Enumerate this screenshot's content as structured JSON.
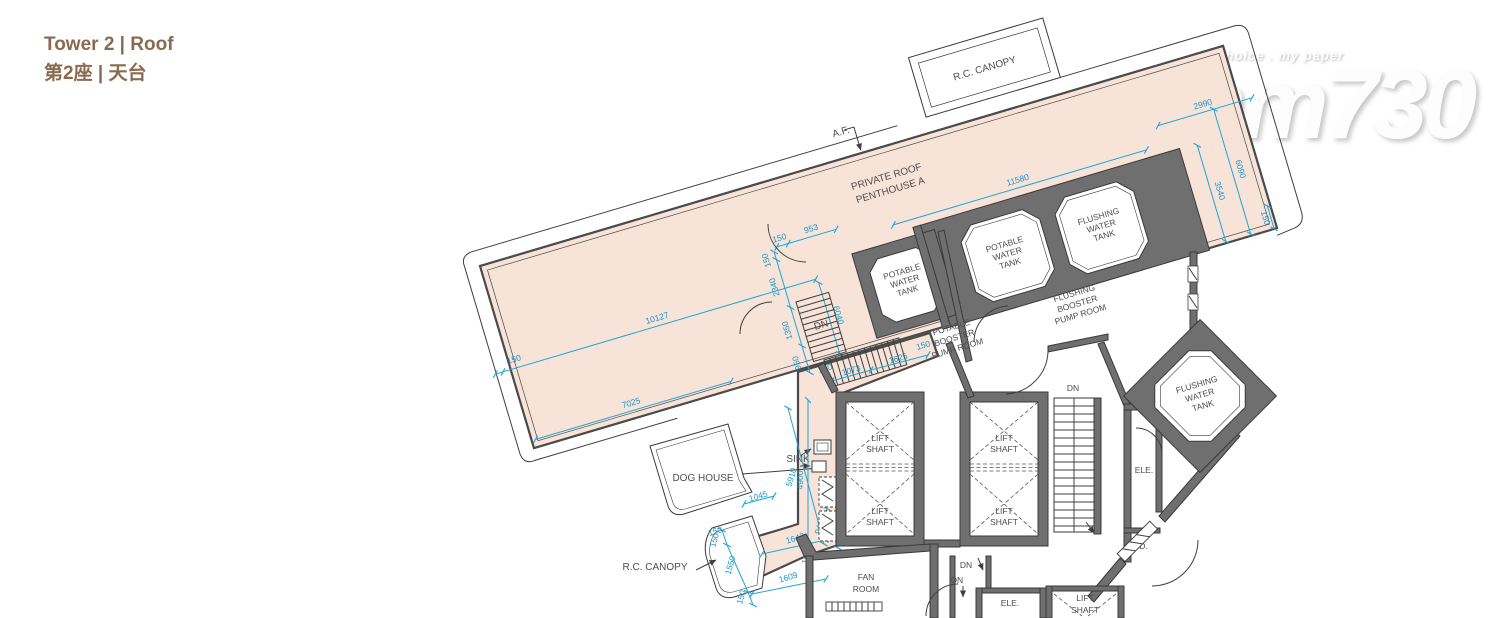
{
  "header": {
    "title_en": "Tower 2 | Roof",
    "title_zh": "第2座 | 天台"
  },
  "watermark": {
    "tagline": "my choice . my paper",
    "logo": "am730"
  },
  "plan": {
    "labels": {
      "af": "A.F.",
      "rc_canopy": "R.C. CANOPY",
      "private_roof_1": "PRIVATE ROOF",
      "private_roof_2": "PENTHOUSE A",
      "w_potable": "POTABLE",
      "w_flushing": "FLUSHING",
      "w_water": "WATER",
      "w_tank": "TANK",
      "w_booster": "BOOSTER",
      "w_pump_room": "PUMP ROOM",
      "lift": "LIFT",
      "shaft": "SHAFT",
      "dn": "DN",
      "ele": "ELE.",
      "pd": "P.D.",
      "fan": "FAN",
      "room": "ROOM",
      "dog_house": "DOG HOUSE",
      "sink": "SINK"
    },
    "dims": {
      "d150": "150",
      "d953": "953",
      "d2340": "2340",
      "d1350": "1350",
      "d950": "950",
      "d10127": "10127",
      "d7025": "7025",
      "d6040": "6040",
      "d11580": "11580",
      "d2990": "2990",
      "d6090": "6090",
      "d3540": "3540",
      "d1073": "1073",
      "d1625": "1625",
      "d1045": "1045",
      "d1550": "1550",
      "d1642": "1642",
      "d1609": "1609",
      "d941": "941",
      "d105": "105",
      "d5910": "5910",
      "d4900": "4900"
    },
    "colors": {
      "dim_blue": "#1ea5d9",
      "roof_fill": "#f8e3d8",
      "wall_gray": "#6f6f6f",
      "title_brown": "#8a6a50"
    }
  }
}
